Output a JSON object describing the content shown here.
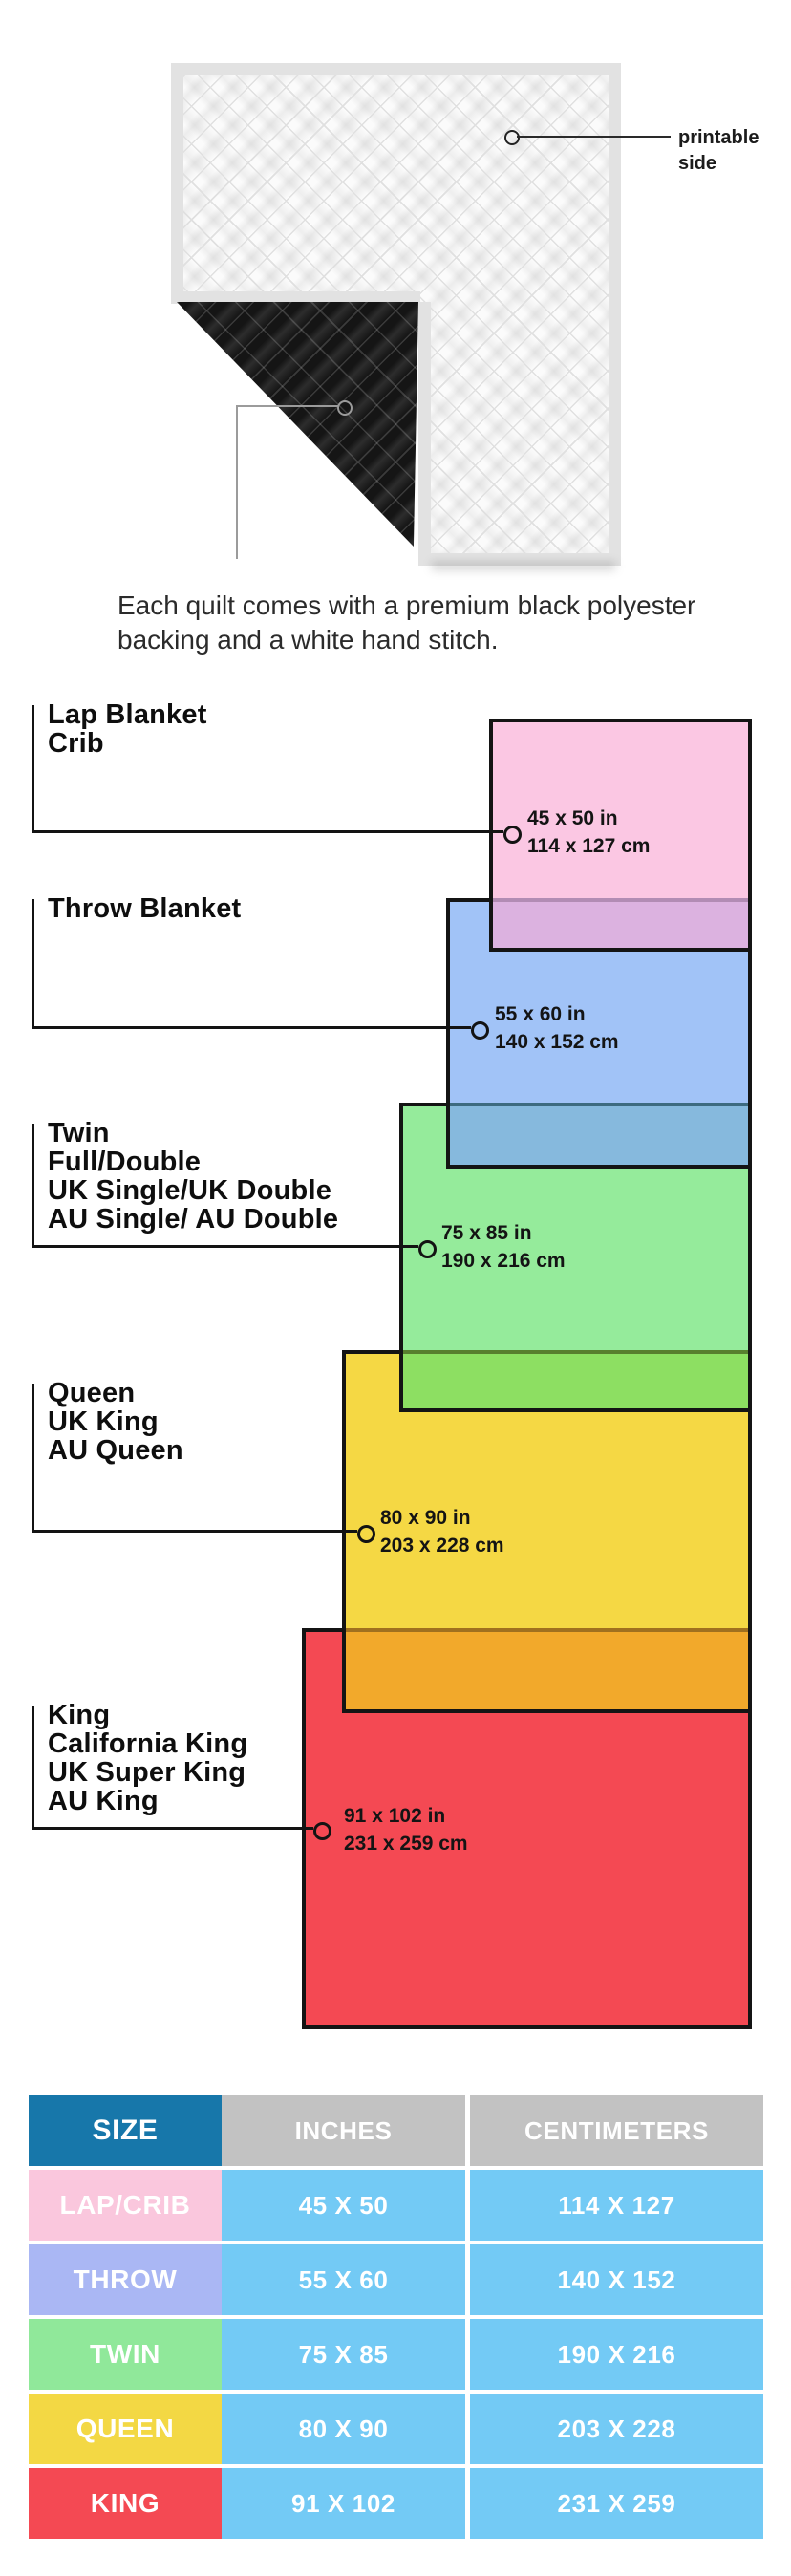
{
  "quilt": {
    "printable_label_lines": [
      "printable",
      "side"
    ],
    "caption_lines": [
      "Each quilt comes with a premium black polyester",
      "backing and a white hand stitch."
    ],
    "front_color": "#fbfbfb",
    "back_color": "#151515",
    "binding_color": "#e2e2e2"
  },
  "diagram": {
    "line_color": "#131313",
    "sizes": [
      {
        "name": "lap-crib",
        "labels": [
          "Lap Blanket",
          "Crib"
        ],
        "inches": "45 x 50 in",
        "centimeters": "114 x 127 cm",
        "fill": "#FBC7E3"
      },
      {
        "name": "throw",
        "labels": [
          "Throw Blanket"
        ],
        "inches": "55 x 60 in",
        "centimeters": "140 x 152 cm",
        "fill": "#A1C3F7"
      },
      {
        "name": "twin",
        "labels": [
          "Twin",
          "Full/Double",
          "UK Single/UK Double",
          "AU Single/ AU Double"
        ],
        "inches": "75 x 85 in",
        "centimeters": "190 x 216 cm",
        "fill": "#95EB9B"
      },
      {
        "name": "queen",
        "labels": [
          "Queen",
          "UK King",
          "AU Queen"
        ],
        "inches": "80 x 90 in",
        "centimeters": "203 x 228 cm",
        "fill": "#F5D844"
      },
      {
        "name": "king",
        "labels": [
          "King",
          "California King",
          "UK Super King",
          "AU King"
        ],
        "inches": "91 x 102 in",
        "centimeters": "231 x 259 cm",
        "fill": "#F44953"
      }
    ],
    "overlap_fills": {
      "pink_over_blue": "#DCB2E0",
      "blue_over_green": "#86B9DD",
      "green_over_yellow": "#8DDF62",
      "yellow_over_red": "#F2A92B"
    }
  },
  "table": {
    "headers": [
      "SIZE",
      "INCHES",
      "CENTIMETERS"
    ],
    "header_bg_size": "#1777AA",
    "header_bg_other": "#C2C2C2",
    "cell_bg": "#73CAF5",
    "rows": [
      {
        "size": "LAP/CRIB",
        "inches": "45 X 50",
        "centimeters": "114 X 127",
        "label_bg": "#FAC7DD"
      },
      {
        "size": "THROW",
        "inches": "55 X 60",
        "centimeters": "140 X 152",
        "label_bg": "#AAB7F4"
      },
      {
        "size": "TWIN",
        "inches": "75 X 85",
        "centimeters": "190 X 216",
        "label_bg": "#90E89A"
      },
      {
        "size": "QUEEN",
        "inches": "80 X 90",
        "centimeters": "203 X 228",
        "label_bg": "#F3D844"
      },
      {
        "size": "KING",
        "inches": "91 X 102",
        "centimeters": "231 X 259",
        "label_bg": "#F44953"
      }
    ]
  }
}
